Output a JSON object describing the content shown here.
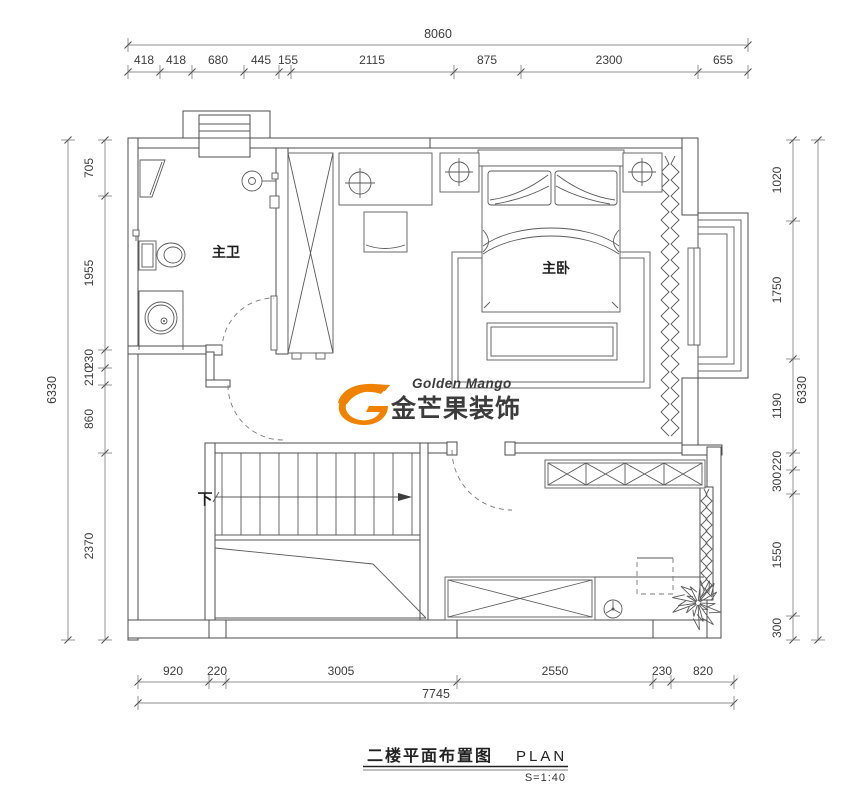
{
  "dims": {
    "top": {
      "total": "8060",
      "segments": [
        "418",
        "418",
        "680",
        "445",
        "155",
        "2115",
        "875",
        "2300",
        "655"
      ]
    },
    "bottom": {
      "total": "7745",
      "segments": [
        "920",
        "220",
        "3005",
        "2550",
        "230",
        "820"
      ]
    },
    "left": {
      "total": "6330",
      "segments": [
        "705",
        "1955",
        "230",
        "210",
        "860",
        "2370"
      ]
    },
    "right": {
      "total": "6330",
      "segments": [
        "1020",
        "1750",
        "1190",
        "220",
        "300",
        "1550",
        "300"
      ]
    }
  },
  "rooms": {
    "master_bath": "主卫",
    "master_bedroom": "主卧",
    "stair_down": "下"
  },
  "logo": {
    "name_en": "Golden Mango",
    "name_cn": "金芒果",
    "suffix_cn": "装饰",
    "color_orange": "#F08200",
    "color_brown": "#8C4212",
    "color_dark": "#55463C"
  },
  "titleblock": {
    "title_cn": "二楼平面布置图",
    "title_en": "PLAN",
    "scale": "S=1:40"
  }
}
